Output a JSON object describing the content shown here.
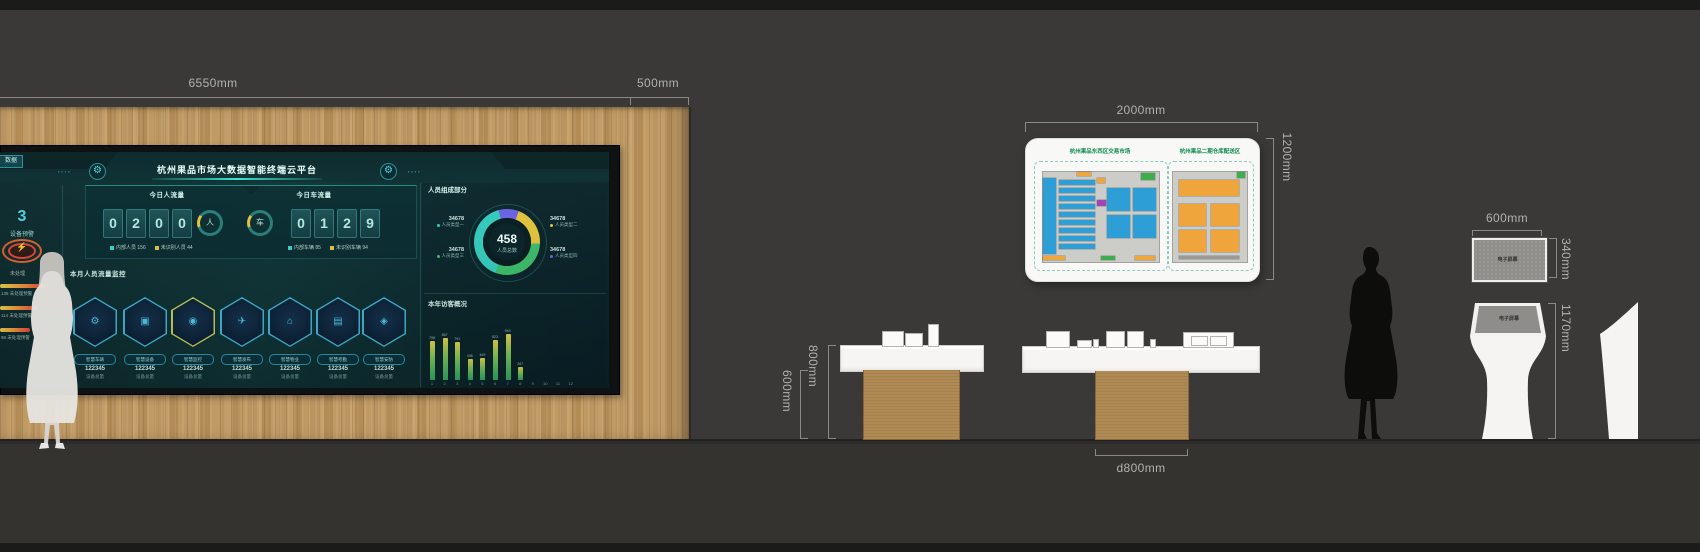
{
  "scene": {
    "dims": {
      "wall_width": "6550mm",
      "wall_side": "500mm",
      "board_width": "2000mm",
      "board_height": "1200mm",
      "table_height": "800mm",
      "table_leg_height": "600mm",
      "table_depth": "d800mm",
      "screen_width": "600mm",
      "screen_height": "340mm",
      "kiosk_height": "1170mm"
    },
    "wall_screen_label": "电子屏幕",
    "kiosk_screen_label": "电子屏幕"
  },
  "colors": {
    "accent_cyan": "#3ee6d2",
    "wood": "#bb9560",
    "alert_orange": "#e2622a",
    "bar_top": "#e8d44a",
    "bar_bottom": "#2ba864"
  },
  "dashboard": {
    "title": "杭州果品市场大数据智能终端云平台",
    "tab_label": "数据",
    "alerts": {
      "count": "3",
      "label": "设备预警",
      "pending": "未处理",
      "gauges": [
        {
          "text": "135 未处理预警",
          "w": 46
        },
        {
          "text": "114 未处理预警",
          "w": 38
        },
        {
          "text": "98 未处理预警",
          "w": 30
        }
      ]
    },
    "people": {
      "title": "今日人流量",
      "digits": "0200",
      "icon": "人",
      "legend": [
        {
          "text": "内部人员 156",
          "color": "#3ad8c8"
        },
        {
          "text": "未识别人员 44",
          "color": "#e8c93e"
        }
      ]
    },
    "vehicles": {
      "title": "今日车流量",
      "digits": "0129",
      "icon": "车",
      "legend": [
        {
          "text": "内部车辆 85",
          "color": "#3ad8c8"
        },
        {
          "text": "未识别车辆 94",
          "color": "#e8c93e"
        }
      ]
    },
    "monitor": {
      "title": "本月人员流量监控",
      "modules": [
        {
          "label": "智慧车辆",
          "value": "122345",
          "unit": "设备总量",
          "icon": "⚙",
          "icon_name": "car-icon",
          "accent": "#3fb6d8"
        },
        {
          "label": "智慧设备",
          "value": "122345",
          "unit": "设备总量",
          "icon": "▣",
          "icon_name": "box-icon",
          "accent": "#3fb6d8"
        },
        {
          "label": "智慧监控",
          "value": "122345",
          "unit": "设备总量",
          "icon": "◉",
          "icon_name": "camera-icon",
          "accent": "#c3cf5e"
        },
        {
          "label": "智慧发布",
          "value": "122345",
          "unit": "设备总量",
          "icon": "✈",
          "icon_name": "send-icon",
          "accent": "#3fb6d8"
        },
        {
          "label": "智慧物业",
          "value": "122345",
          "unit": "设备总量",
          "icon": "⌂",
          "icon_name": "building-icon",
          "accent": "#3fb6d8"
        },
        {
          "label": "智慧考勤",
          "value": "122345",
          "unit": "设备总量",
          "icon": "▤",
          "icon_name": "document-icon",
          "accent": "#3fb6d8"
        },
        {
          "label": "智慧安防",
          "value": "122345",
          "unit": "设备总量",
          "icon": "◈",
          "icon_name": "shield-icon",
          "accent": "#3fb6d8"
        }
      ]
    },
    "composition": {
      "title": "人员组成部分",
      "total": "458",
      "total_label": "人员总数",
      "draw_order": [
        3,
        1,
        2,
        0
      ],
      "segments": [
        {
          "name": "人员类型一",
          "value": "34678",
          "color": "#36d0c2",
          "pct": 40,
          "side": "left",
          "row": 0
        },
        {
          "name": "人员类型二",
          "value": "34678",
          "color": "#ecc83d",
          "pct": 20,
          "side": "right",
          "row": 0
        },
        {
          "name": "人员类型三",
          "value": "34678",
          "color": "#3fbf6b",
          "pct": 30,
          "side": "left",
          "row": 1
        },
        {
          "name": "人员类型四",
          "value": "34678",
          "color": "#6f63e8",
          "pct": 10,
          "side": "right",
          "row": 1
        }
      ]
    },
    "visitors": {
      "title": "本年访客概况",
      "max": 950,
      "months": [
        "1",
        "2",
        "3",
        "4",
        "5",
        "6",
        "7",
        "8",
        "9",
        "10",
        "11",
        "12"
      ],
      "values": [
        798,
        867,
        791,
        436,
        449,
        823,
        949,
        267,
        null,
        null,
        null,
        null
      ]
    }
  },
  "board": {
    "plans": [
      {
        "title": "杭州果品东西区交易市场",
        "primary": "#2e9fd6",
        "blocks": [
          {
            "x": 0,
            "y": 6,
            "w": 13,
            "h": 76,
            "c": "#2e9fd6"
          },
          {
            "x": 16,
            "y": 8,
            "w": 36,
            "h": 5,
            "c": "#2e9fd6"
          },
          {
            "x": 16,
            "y": 16,
            "w": 36,
            "h": 5,
            "c": "#2e9fd6"
          },
          {
            "x": 16,
            "y": 24,
            "w": 36,
            "h": 5,
            "c": "#2e9fd6"
          },
          {
            "x": 16,
            "y": 32,
            "w": 36,
            "h": 5,
            "c": "#2e9fd6"
          },
          {
            "x": 16,
            "y": 40,
            "w": 36,
            "h": 5,
            "c": "#2e9fd6"
          },
          {
            "x": 16,
            "y": 48,
            "w": 36,
            "h": 5,
            "c": "#2e9fd6"
          },
          {
            "x": 16,
            "y": 56,
            "w": 36,
            "h": 5,
            "c": "#2e9fd6"
          },
          {
            "x": 16,
            "y": 64,
            "w": 36,
            "h": 5,
            "c": "#2e9fd6"
          },
          {
            "x": 16,
            "y": 72,
            "w": 36,
            "h": 5,
            "c": "#2e9fd6"
          },
          {
            "x": 64,
            "y": 16,
            "w": 23,
            "h": 23,
            "c": "#2e9fd6"
          },
          {
            "x": 90,
            "y": 16,
            "w": 23,
            "h": 23,
            "c": "#2e9fd6"
          },
          {
            "x": 64,
            "y": 43,
            "w": 23,
            "h": 23,
            "c": "#2e9fd6"
          },
          {
            "x": 90,
            "y": 43,
            "w": 23,
            "h": 23,
            "c": "#2e9fd6"
          },
          {
            "x": 54,
            "y": 28,
            "w": 9,
            "h": 6,
            "c": "#a144b8"
          },
          {
            "x": 34,
            "y": 0,
            "w": 14,
            "h": 4,
            "c": "#f0a43c"
          },
          {
            "x": 54,
            "y": 6,
            "w": 8,
            "h": 5,
            "c": "#f0a43c"
          },
          {
            "x": 98,
            "y": 1,
            "w": 14,
            "h": 7,
            "c": "#3fae4a"
          },
          {
            "x": 58,
            "y": 84,
            "w": 14,
            "h": 4,
            "c": "#3fae4a"
          },
          {
            "x": 0,
            "y": 84,
            "w": 22,
            "h": 4,
            "c": "#f0a43c"
          },
          {
            "x": 92,
            "y": 84,
            "w": 20,
            "h": 4,
            "c": "#f0a43c"
          }
        ]
      },
      {
        "title": "杭州果品二期仓库配送区",
        "primary": "#f0a43c",
        "blocks": [
          {
            "x": 6,
            "y": 8,
            "w": 60,
            "h": 16,
            "c": "#f0a43c"
          },
          {
            "x": 6,
            "y": 32,
            "w": 27,
            "h": 22,
            "c": "#f0a43c"
          },
          {
            "x": 38,
            "y": 32,
            "w": 28,
            "h": 22,
            "c": "#f0a43c"
          },
          {
            "x": 6,
            "y": 58,
            "w": 27,
            "h": 22,
            "c": "#f0a43c"
          },
          {
            "x": 38,
            "y": 58,
            "w": 28,
            "h": 22,
            "c": "#f0a43c"
          },
          {
            "x": 64,
            "y": 0,
            "w": 8,
            "h": 6,
            "c": "#3fae4a"
          },
          {
            "x": 6,
            "y": 84,
            "w": 60,
            "h": 3,
            "c": "#9a9a97"
          }
        ]
      }
    ]
  },
  "tables": {
    "table1_models": [
      {
        "x": 882,
        "y": 331,
        "w": 20,
        "h": 14
      },
      {
        "x": 905,
        "y": 333,
        "w": 16,
        "h": 12
      },
      {
        "x": 928,
        "y": 324,
        "w": 9,
        "h": 21
      }
    ],
    "table2_models": [
      {
        "x": 1046,
        "y": 331,
        "w": 22,
        "h": 15
      },
      {
        "x": 1077,
        "y": 340,
        "w": 13,
        "h": 6
      },
      {
        "x": 1093,
        "y": 339,
        "w": 4,
        "h": 7
      },
      {
        "x": 1106,
        "y": 331,
        "w": 17,
        "h": 15
      },
      {
        "x": 1127,
        "y": 331,
        "w": 15,
        "h": 15
      },
      {
        "x": 1150,
        "y": 339,
        "w": 4,
        "h": 7
      },
      {
        "x": 1183,
        "y": 332,
        "w": 49,
        "h": 14,
        "windows": 2
      }
    ]
  }
}
